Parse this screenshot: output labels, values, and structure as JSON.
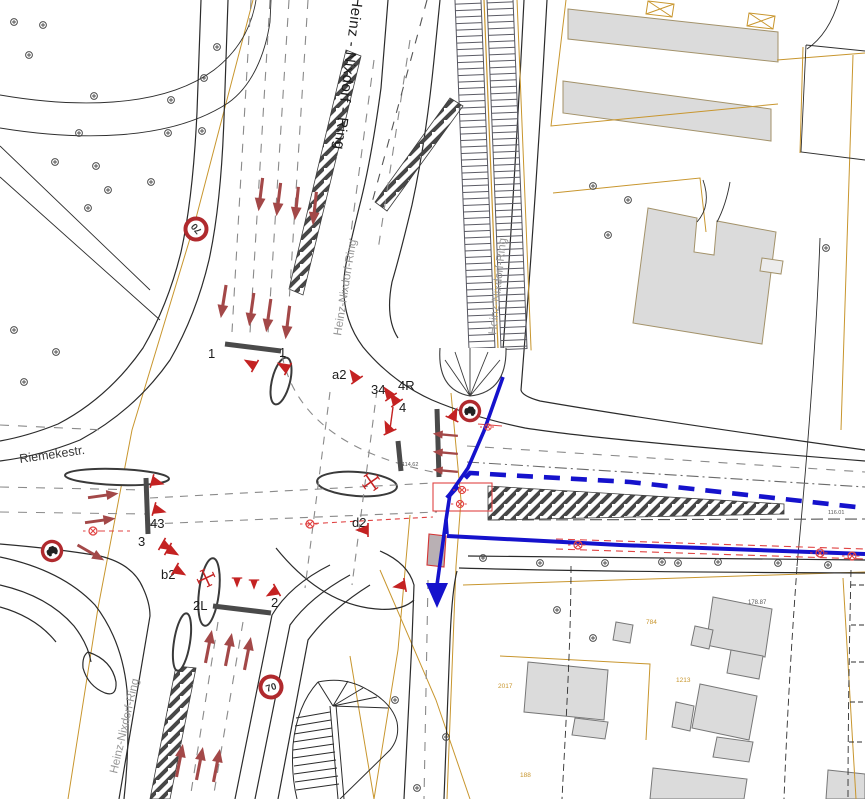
{
  "streets": {
    "main": "Heinz - Nixdorf - Ring",
    "north_small": "Heinz-Nixdorf-Ring",
    "center_small": "Heinz-Nixdorf-Ring",
    "south_small": "Heinz-Nixdorf-Ring",
    "west": "Riemekestr."
  },
  "signal_labels": {
    "n1_west": "1",
    "n1_east": "1",
    "a2": "a2",
    "g34": "34",
    "g4r": "4R",
    "g4": "4",
    "d2": "d2",
    "g43": "43",
    "g3": "3",
    "b2": "b2",
    "g2l": "2L",
    "g2": "2"
  },
  "signs": {
    "speed_limit_north": "70",
    "speed_limit_south": "70"
  },
  "elevations": {
    "center": "114.62",
    "east": "116.01",
    "southeast": "178.87"
  },
  "parcel_numbers": {
    "p1": "784",
    "p2": "1213",
    "p3": "2017",
    "p4": "188"
  },
  "colors": {
    "line": "#2e2e2e",
    "parcel": "#c8962e",
    "building_fill": "#dbdbdb",
    "signal_red": "#c42222",
    "lane_arrow": "#a34848",
    "route_blue": "#1512cc",
    "detector_red": "#e04343",
    "sign_ring": "#b02a2e",
    "label_gray": "#969696"
  }
}
